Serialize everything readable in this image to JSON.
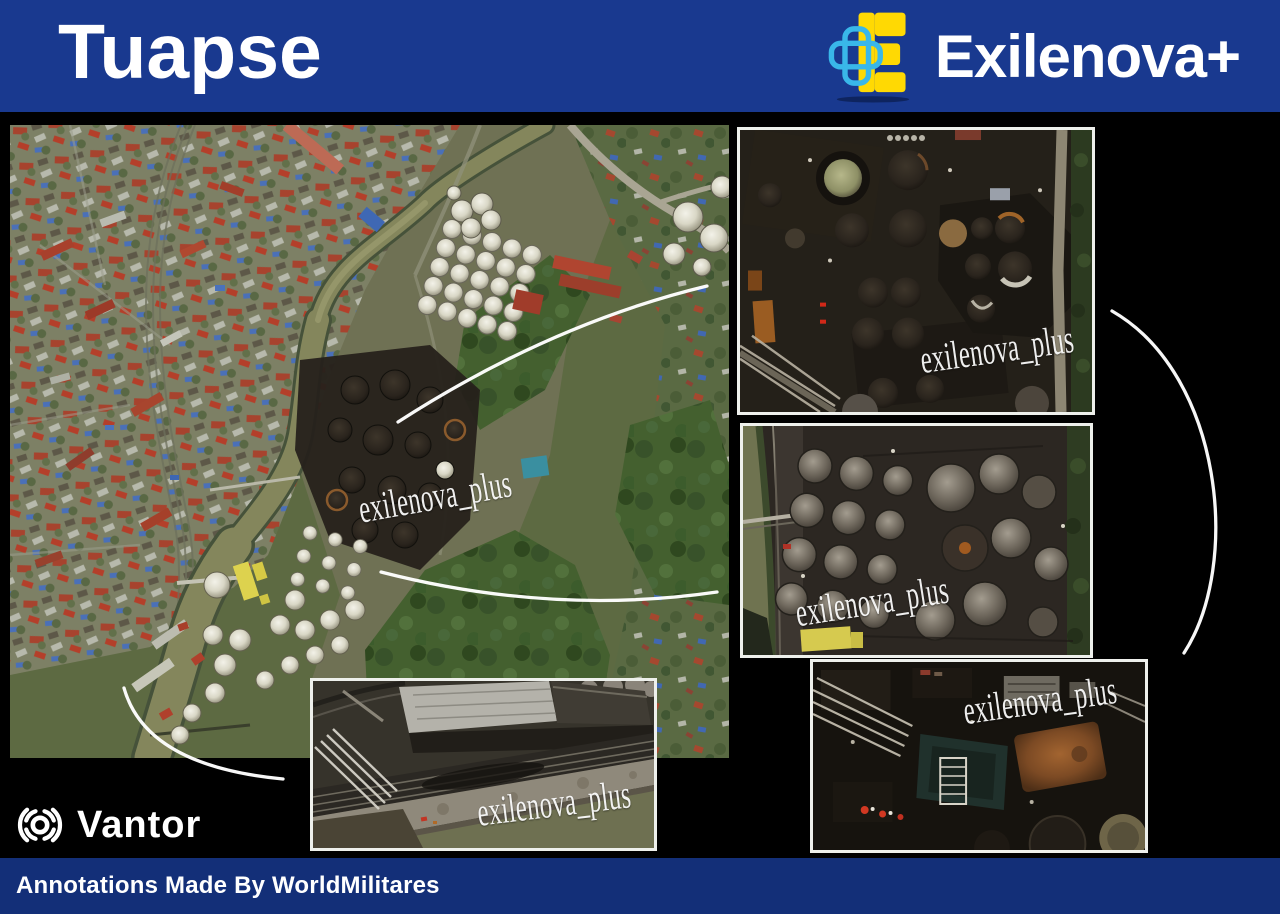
{
  "header": {
    "title": "Tuapse",
    "brand_name": "Exilenova+"
  },
  "watermark": "exilenova_plus",
  "vantor": {
    "name": "Vantor"
  },
  "footer": {
    "credit": "Annotations Made By WorldMilitares"
  },
  "icons": {
    "brand": "exilenova-plus-logo",
    "vantor": "vantor-aperture-logo"
  },
  "colors": {
    "header_blue": "#19398f",
    "footer_blue": "#132f78",
    "brand_yellow": "#ffd903",
    "brand_cyan": "#39b7e9",
    "annotation_white": "#ffffff",
    "background": "#000000"
  }
}
